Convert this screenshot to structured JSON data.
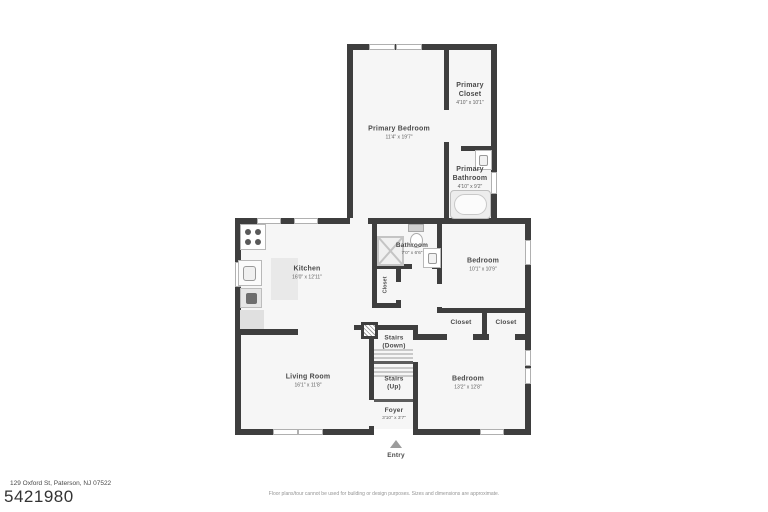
{
  "colors": {
    "wall": "#3e3e3e",
    "floor": "#f6f6f6",
    "label": "#4a4a4a"
  },
  "rooms": {
    "primary_bedroom": {
      "name": "Primary Bedroom",
      "dims": "11'4\" x 19'7\""
    },
    "primary_closet": {
      "name": "Primary Closet",
      "dims": "4'10\" x 10'1\""
    },
    "primary_bathroom": {
      "name": "Primary Bathroom",
      "dims": "4'10\" x 9'2\""
    },
    "bathroom": {
      "name": "Bathroom",
      "dims": "7'0\" x 6'6\""
    },
    "bedroom_upper": {
      "name": "Bedroom",
      "dims": "10'1\" x 10'9\""
    },
    "kitchen": {
      "name": "Kitchen",
      "dims": "16'0\" x 12'11\""
    },
    "hall_closet": {
      "name": "Closet"
    },
    "closet_left": {
      "name": "Closet"
    },
    "closet_right": {
      "name": "Closet"
    },
    "stairs_down": {
      "line1": "Stairs",
      "line2": "(Down)"
    },
    "stairs_up": {
      "line1": "Stairs",
      "line2": "(Up)"
    },
    "living_room": {
      "name": "Living Room",
      "dims": "16'1\" x 11'8\""
    },
    "bedroom_lower": {
      "name": "Bedroom",
      "dims": "13'2\" x 12'8\""
    },
    "foyer": {
      "name": "Foyer",
      "dims": "3'10\" x 3'7\""
    }
  },
  "entry": {
    "label": "Entry"
  },
  "footer": {
    "address": "129 Oxford St, Paterson, NJ 07522",
    "listing_number": "5421980",
    "disclaimer": "Floor plans/tour cannot be used for building or design purposes. Sizes and dimensions are approximate."
  }
}
